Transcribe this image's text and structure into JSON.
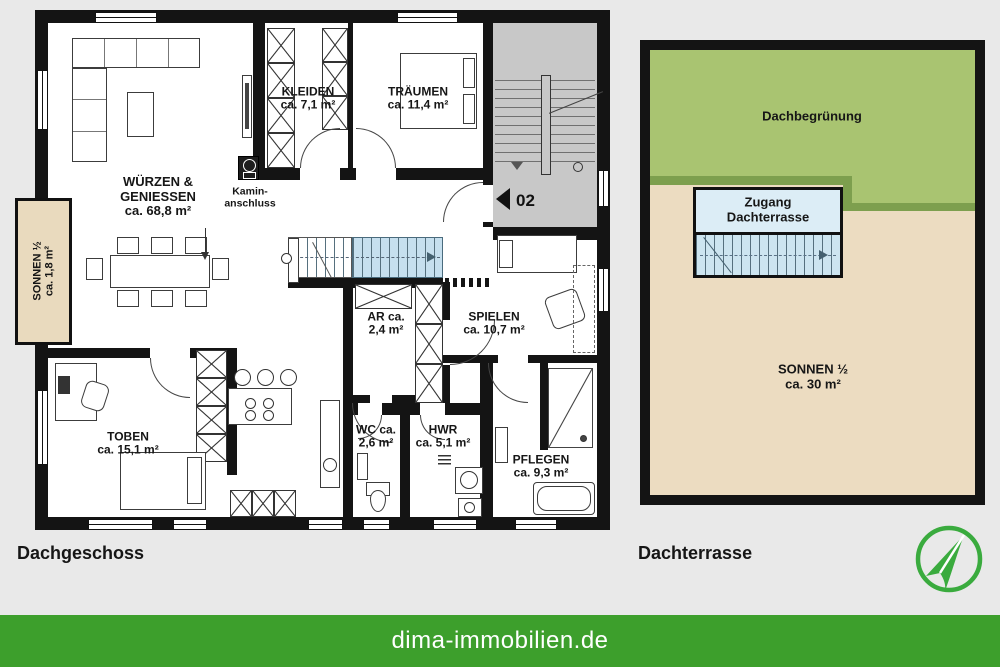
{
  "page": {
    "background_color": "#e9e9e9"
  },
  "captions": {
    "left_plan": "Dachgeschoss",
    "right_plan": "Dachterrasse"
  },
  "footer": {
    "website": "dima-immobilien.de",
    "background_color": "#3d9f2c",
    "text_color": "#ffffff"
  },
  "logo": {
    "icon": "north-arrow-icon",
    "color": "#3aab3e"
  },
  "dachgeschoss": {
    "unit_marker": "02",
    "balcony_label": {
      "line1": "SONNEN ½",
      "line2": "ca. 1,8 m²"
    },
    "chimney_label": {
      "line1": "Kamin-",
      "line2": "anschluss"
    },
    "rooms": [
      {
        "id": "wuerzen-geniessen",
        "lines": [
          "WÜRZEN &",
          "GENIESSEN",
          "ca. 68,8 m²"
        ]
      },
      {
        "id": "kleiden",
        "lines": [
          "KLEIDEN",
          "ca. 7,1 m²"
        ]
      },
      {
        "id": "traeumen",
        "lines": [
          "TRÄUMEN",
          "ca. 11,4 m²"
        ]
      },
      {
        "id": "abstellraum",
        "lines": [
          "AR ca.",
          "2,4 m²"
        ]
      },
      {
        "id": "spielen",
        "lines": [
          "SPIELEN",
          "ca. 10,7 m²"
        ]
      },
      {
        "id": "toben",
        "lines": [
          "TOBEN",
          "ca. 15,1 m²"
        ]
      },
      {
        "id": "wc",
        "lines": [
          "WC ca.",
          "2,6 m²"
        ]
      },
      {
        "id": "hwr",
        "lines": [
          "HWR",
          "ca. 5,1 m²"
        ]
      },
      {
        "id": "pflegen",
        "lines": [
          "PFLEGEN",
          "ca. 9,3 m²"
        ]
      }
    ],
    "colors": {
      "wall": "#141414",
      "floor": "#ffffff",
      "stairwell": "#c8c8c8",
      "stair_highlight": "#c6dfee",
      "balcony": "#e9dabe"
    }
  },
  "dachterrasse": {
    "green_roof_label": "Dachbegrünung",
    "access_label": {
      "line1": "Zugang",
      "line2": "Dachterrasse"
    },
    "terrace_label": {
      "line1": "SONNEN ½",
      "line2": "ca. 30 m²"
    },
    "colors": {
      "green_roof": "#a9c471",
      "green_roof_edge": "#7d9f4e",
      "terrace": "#ecdcc1",
      "access_header": "#dcedf6",
      "access_stairs": "#cde5f0"
    }
  }
}
